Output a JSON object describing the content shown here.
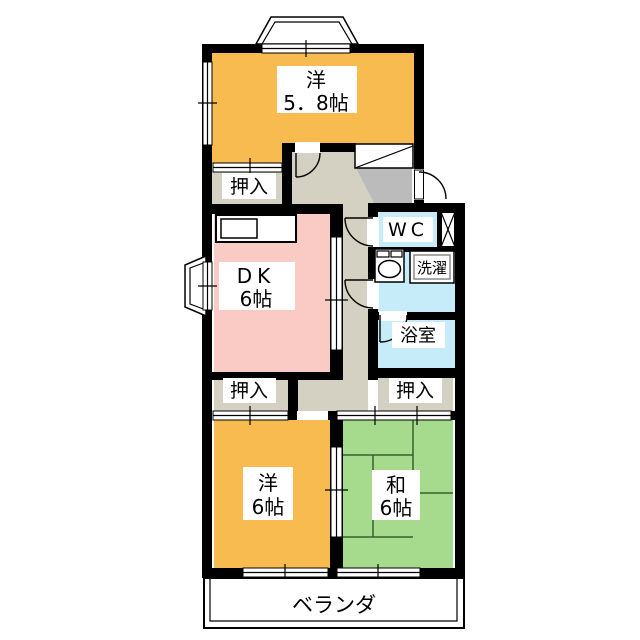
{
  "colors": {
    "wall": "#000000",
    "room_western": "#F8BB50",
    "room_dk": "#FACAC5",
    "room_tatami": "#A6DB8D",
    "room_water": "#C5ECF8",
    "corridor": "#D4D1C3",
    "genkan": "#BBBBBB",
    "tatami_line": "#35622F"
  },
  "labels": {
    "western_58": {
      "line1": "洋",
      "line2": "5．8帖"
    },
    "dk": {
      "line1": "DK",
      "line2": "6帖"
    },
    "wc": "WC",
    "laundry": "洗濯",
    "bath": "浴室",
    "western_6": {
      "line1": "洋",
      "line2": "6帖"
    },
    "japanese_6": {
      "line1": "和",
      "line2": "6帖"
    },
    "balcony": "ベランダ",
    "closets": [
      "押入",
      "押入",
      "押入"
    ]
  }
}
